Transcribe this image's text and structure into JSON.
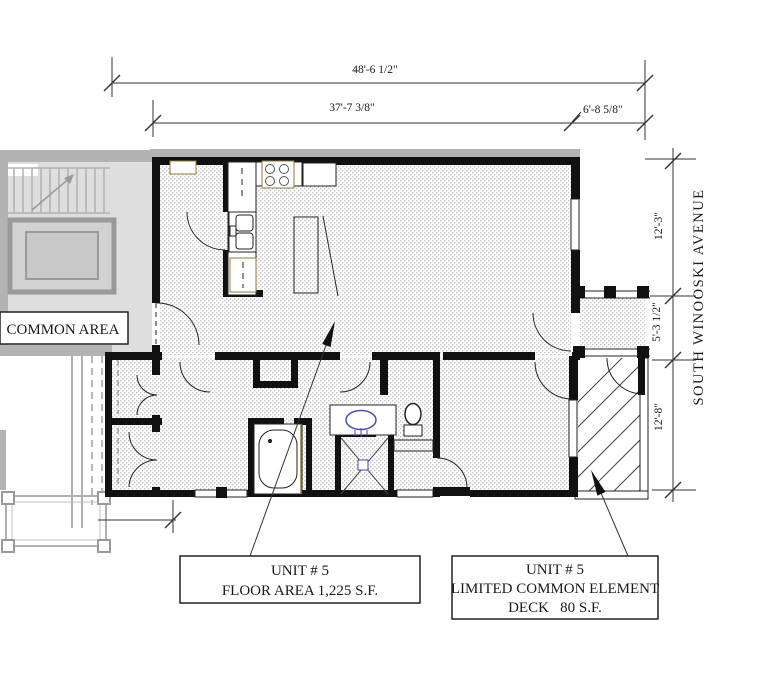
{
  "dimensions": {
    "overall_width": "48'-6 1/2\"",
    "upper_width": "37'-7 3/8\"",
    "entry_width": "6'-8 5/8\"",
    "side_upper": "12'-3\"",
    "side_middle": "5'-3 1/2\"",
    "side_lower": "12'-8\""
  },
  "labels": {
    "street": "SOUTH WINOOSKI AVENUE",
    "common_area": "COMMON AREA",
    "unit_box": {
      "line1": "UNIT # 5",
      "line2": "FLOOR AREA 1,225 S.F."
    },
    "deck_box": {
      "line1": "UNIT # 5",
      "line2": "LIMITED COMMON ELEMENT",
      "line3": "DECK   80 S.F."
    }
  },
  "colors": {
    "wall": "#111111",
    "dim_line": "#333333",
    "common_gray": "#b3b3b3",
    "common_fill": "#dedede",
    "floor_dot": "#c6c6c6",
    "fixture_blue": "#4a4ab8",
    "cabinet_tan": "#8c7b3f"
  }
}
